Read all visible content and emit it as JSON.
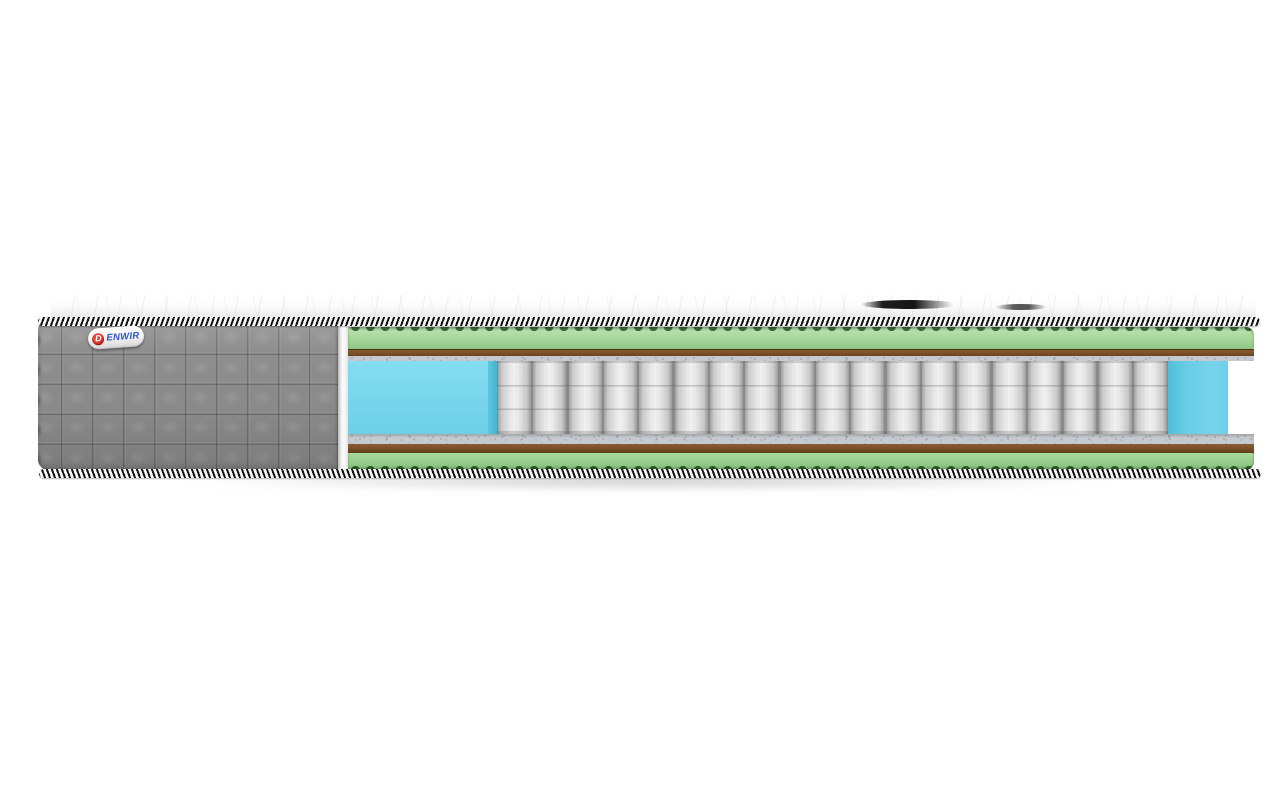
{
  "scene": {
    "description": "Cutaway product render of a pocket-spring mattress on a white background",
    "background": "#ffffff"
  },
  "brand_tag": {
    "letter": "D",
    "text": "ENWIR"
  },
  "construction": {
    "spring_count": 19,
    "handle_shadows": 2,
    "layers": [
      "white quilted top panel",
      "black-white binding tape (top)",
      "green egg-crate foam (top)",
      "brown felt pad (top)",
      "gray spunbond pad (top)",
      "independent pocket springs",
      "blue perimeter support foam (left)",
      "blue perimeter support foam (right)",
      "gray spunbond pad (bottom)",
      "brown felt pad (bottom)",
      "green egg-crate foam (bottom)",
      "black-white binding tape (bottom)",
      "gray quilted side cover"
    ]
  },
  "colors": {
    "page_bg": "#ffffff",
    "quilt_gray": "#8c8c8c",
    "tape_dark": "#131313",
    "tape_light": "#f7f7f7",
    "foam_green": "#a9d99e",
    "foam_green_dark": "#3a6a36",
    "foam_green_bottom": "#9bd191",
    "foam_green_darker": "#305c2b",
    "felt_brown": "#7a4f28",
    "spunbond_gray": "#c4cacf",
    "spring_light": "#f0f0f0",
    "spring_gap": "#8a8a8a",
    "foam_blue": "#76d5ec",
    "foam_blue_dark": "#44b2d1",
    "logo_red": "#c9241f",
    "logo_blue": "#2d55c4"
  }
}
